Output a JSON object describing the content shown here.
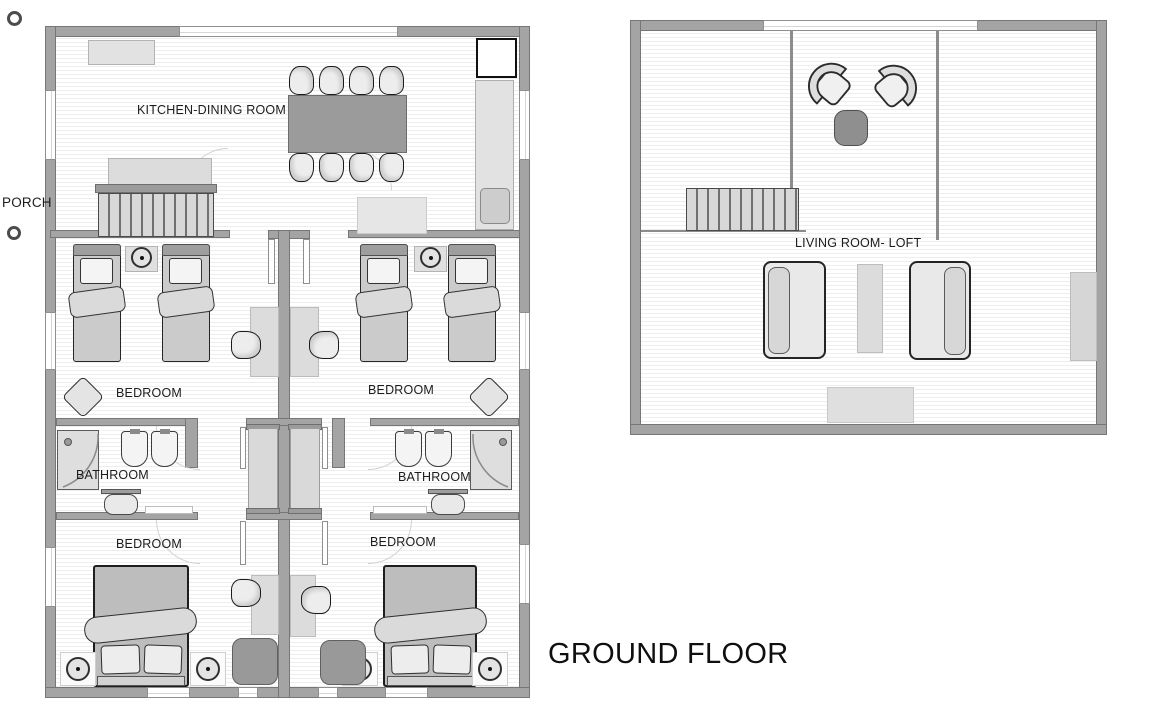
{
  "title": "GROUND FLOOR",
  "left_plan": {
    "porch_label": "PORCH",
    "rooms": {
      "kitchen_dining": "KITCHEN-DINING ROOM",
      "bedroom_top_left": "BEDROOM",
      "bedroom_top_right": "BEDROOM",
      "bathroom_left": "BATHROOM",
      "bathroom_right": "BATHROOM",
      "bedroom_bottom_left": "BEDROOM",
      "bedroom_bottom_right": "BEDROOM"
    }
  },
  "right_plan": {
    "rooms": {
      "living_room_loft": "LIVING ROOM- LOFT"
    }
  },
  "colors": {
    "wall": "#a4a4a4",
    "wall_edge": "#767676",
    "floor_stripe": "#eeeeee",
    "furniture_light": "#dedede",
    "furniture_dark": "#9b9b9b",
    "outline": "#262626",
    "text": "#1c1c1c"
  }
}
